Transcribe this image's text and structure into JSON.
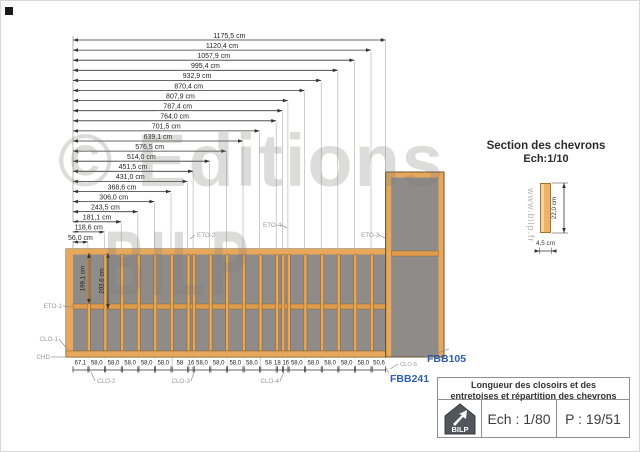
{
  "title_block": {
    "title_line1": "Longueur des closoirs et des",
    "title_line2": "entretoises et répartition des chevrons",
    "scale": "Ech : 1/80",
    "page_number": "P : 19/51",
    "logo_text": "BILP"
  },
  "watermark": {
    "line1": "© Editions",
    "line2": "BILP",
    "website": "www.bilp.fr"
  },
  "section_detail": {
    "title": "Section des chevrons",
    "scale": "Ech:1/10",
    "height_label": "22,0 cm",
    "width_label": "4,5 cm"
  },
  "elevation": {
    "top_dimensions": [
      "1175,5 cm",
      "1120,4 cm",
      "1057,9 cm",
      "995,4 cm",
      "932,9 cm",
      "870,4 cm",
      "807,9 cm",
      "787,4 cm",
      "764,0 cm",
      "701,5 cm",
      "639,1 cm",
      "576,5 cm",
      "514,0 cm",
      "451,5 cm",
      "431,0 cm",
      "368,6 cm",
      "306,0 cm",
      "243,5 cm",
      "181,1 cm",
      "118,6 cm",
      "56,0 cm"
    ],
    "bottom_spacings": [
      "67,1",
      "58,0",
      "58,0",
      "58,0",
      "58,0",
      "58,0",
      "58",
      "16",
      "58,0",
      "58,0",
      "58,0",
      "58,0",
      "58",
      "18,9",
      "16",
      "58,0",
      "58,0",
      "58,0",
      "58,0",
      "58,0",
      "50,6"
    ],
    "panel_vertical_dims": [
      "199,1 cm",
      "203,6 cm"
    ],
    "chevron_width_cm": 4.5,
    "labels": {
      "eto1": "ETO-1",
      "eto2": "ETO-2",
      "eto3": "ETO-3",
      "eto4": "ETO-4",
      "clo1": "CLO-1",
      "clo2": "CLO-2",
      "clo3": "CLO-3",
      "clo4": "CLO-4",
      "clo5": "CLO-5",
      "chd": "CHD",
      "fbb105": "FBB105",
      "fbb241": "FBB241"
    },
    "colors": {
      "frame": "#E8A85C",
      "frame_dark": "#8A5A1C",
      "infill": "#8E8B88",
      "annotation_gray": "#9A9A9A",
      "reference_blue": "#2E5FB0",
      "dim": "#222222"
    }
  }
}
